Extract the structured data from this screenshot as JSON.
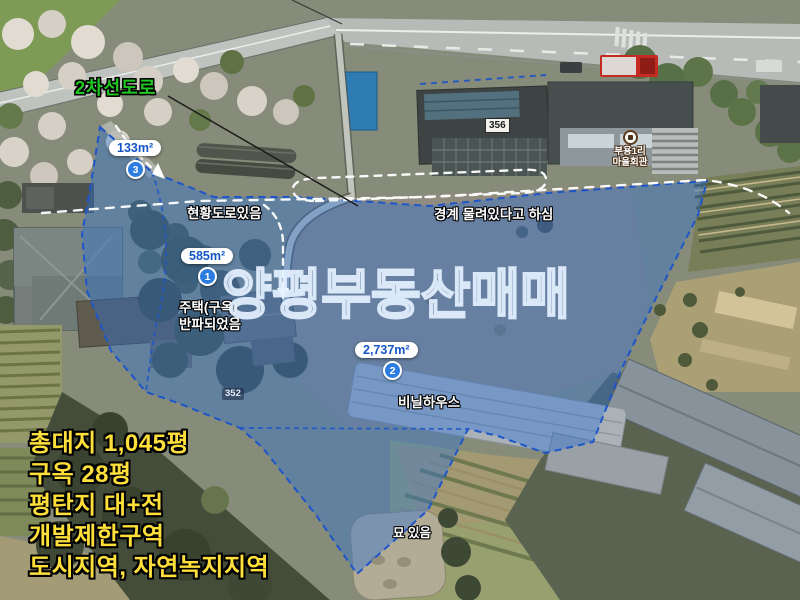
{
  "map_title_watermark": "양평부동산매매",
  "road": {
    "type_label": "2차선도로"
  },
  "area_markers": [
    {
      "number": "3",
      "area_label": "133m²"
    },
    {
      "number": "1",
      "area_label": "585m²"
    },
    {
      "number": "2",
      "area_label": "2,737m²"
    }
  ],
  "notes": {
    "existing_road": "현황도로있음",
    "boundary": "경계 물려있다고 하심",
    "house_line1": "주택(구옥)",
    "house_line2": "반파되었음",
    "vinyl_house": "비닐하우스",
    "grave": "묘 있음"
  },
  "parcel_numbers": {
    "building_356": "356",
    "parcel_352": "352"
  },
  "poi_village_hall": {
    "line1": "부용1리",
    "line2": "마을회관"
  },
  "listing_info": {
    "lines": [
      "총대지 1,045평",
      "구옥 28평",
      "평탄지 대+전",
      "개발제한구역",
      "도시지역, 자연녹지지역"
    ]
  },
  "colors": {
    "overlay_fill": "rgba(43,112,216,0.40)",
    "overlay_boundary": "#1E55C8",
    "road_label_green": "#21C821",
    "info_yellow": "#FFDF3A",
    "pill_blue": "#1456C8"
  }
}
